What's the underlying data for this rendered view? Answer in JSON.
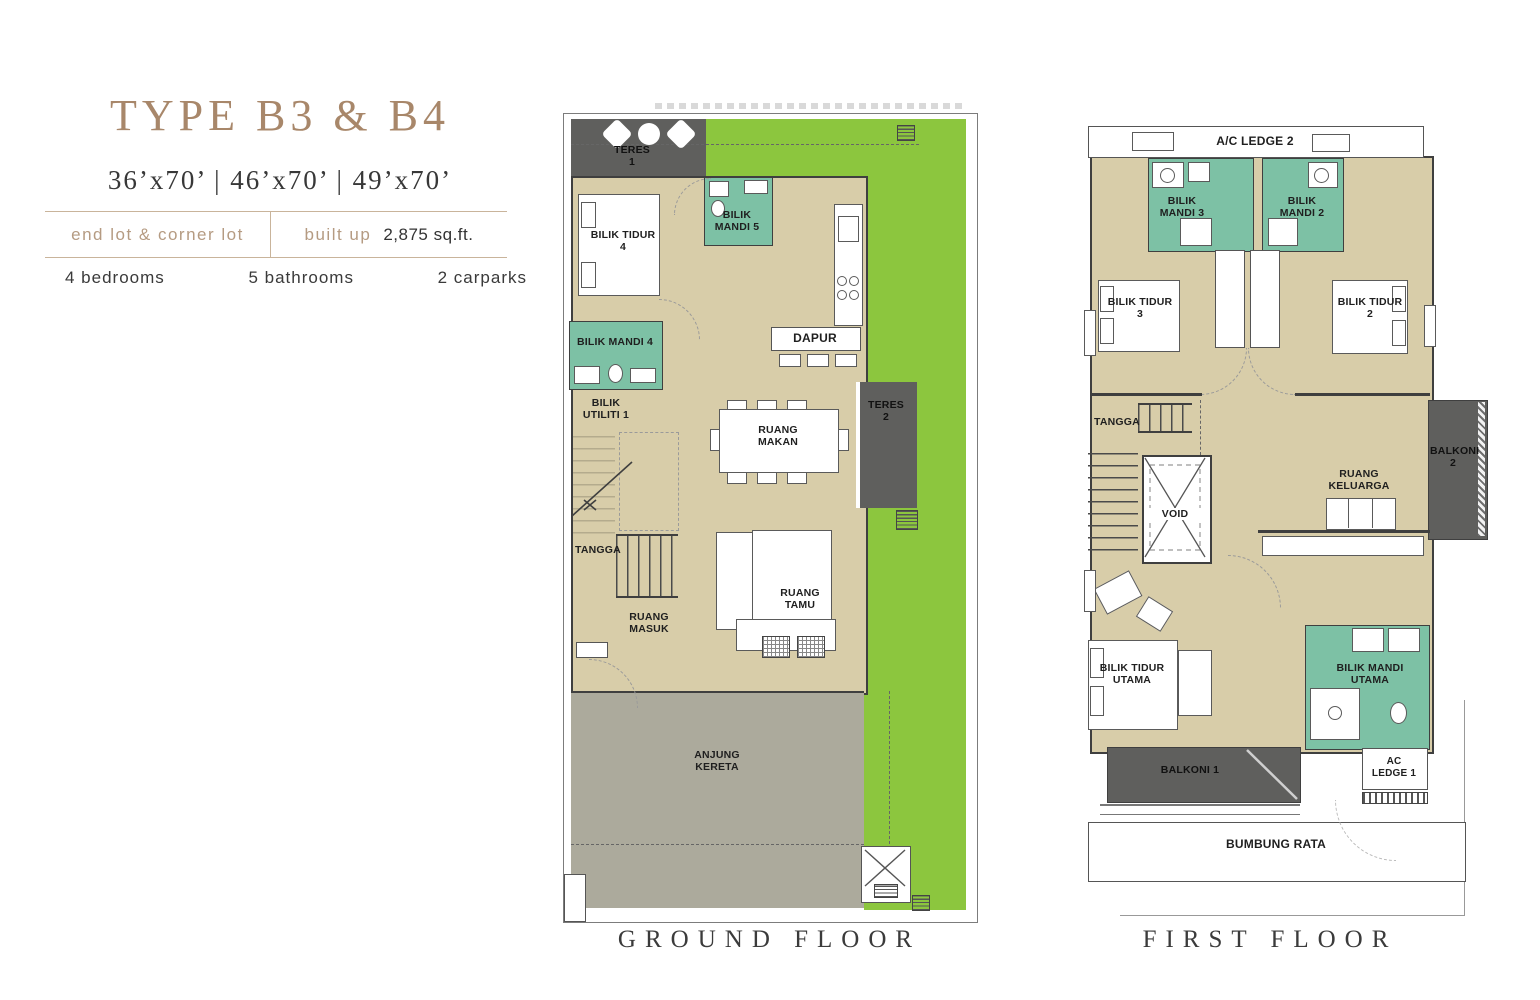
{
  "info": {
    "title": "TYPE B3 & B4",
    "dimensions": "36’x70’ | 46’x70’ | 49’x70’",
    "lot_type": "end lot & corner lot",
    "built_up_label": "built up",
    "built_up_value": "2,875 sq.ft.",
    "bedrooms": "4 bedrooms",
    "bathrooms": "5 bathrooms",
    "carparks": "2 carparks"
  },
  "gf": {
    "caption": "GROUND FLOOR",
    "teres1": "TERES 1",
    "tidur4": "BILIK TIDUR 4",
    "mandi5": "BILIK MANDI 5",
    "dapur": "DAPUR",
    "mandi4": "BILIK MANDI 4",
    "utiliti1": "BILIK UTILITI 1",
    "tangga": "TANGGA",
    "makan": "RUANG MAKAN",
    "teres2": "TERES 2",
    "masuk": "RUANG MASUK",
    "tamu": "RUANG TAMU",
    "anjung": "ANJUNG KERETA"
  },
  "ff": {
    "caption": "FIRST FLOOR",
    "acledge2": "A/C LEDGE 2",
    "mandi3": "BILIK MANDI 3",
    "mandi2": "BILIK MANDI 2",
    "tidur3": "BILIK TIDUR 3",
    "tidur2": "BILIK TIDUR 2",
    "tangga": "TANGGA",
    "void": "VOID",
    "keluarga": "RUANG KELUARGA",
    "balkoni2": "BALKONI 2",
    "tidur_utama": "BILIK TIDUR UTAMA",
    "mandi_utama": "BILIK MANDI UTAMA",
    "balkoni1": "BALKONI 1",
    "acledge1": "AC LEDGE 1",
    "bumbung": "BUMBUNG RATA"
  },
  "colors": {
    "lawn_green": "#8cc63e",
    "floor_beige": "#d8cda9",
    "bathroom_teal": "#7dc1a5",
    "terrace_gray": "#5f5f5d",
    "carport_gray": "#acaa9c",
    "title_tan": "#a8876a",
    "divider_tan": "#c9b49b",
    "text_dark": "#3a3a3a"
  }
}
